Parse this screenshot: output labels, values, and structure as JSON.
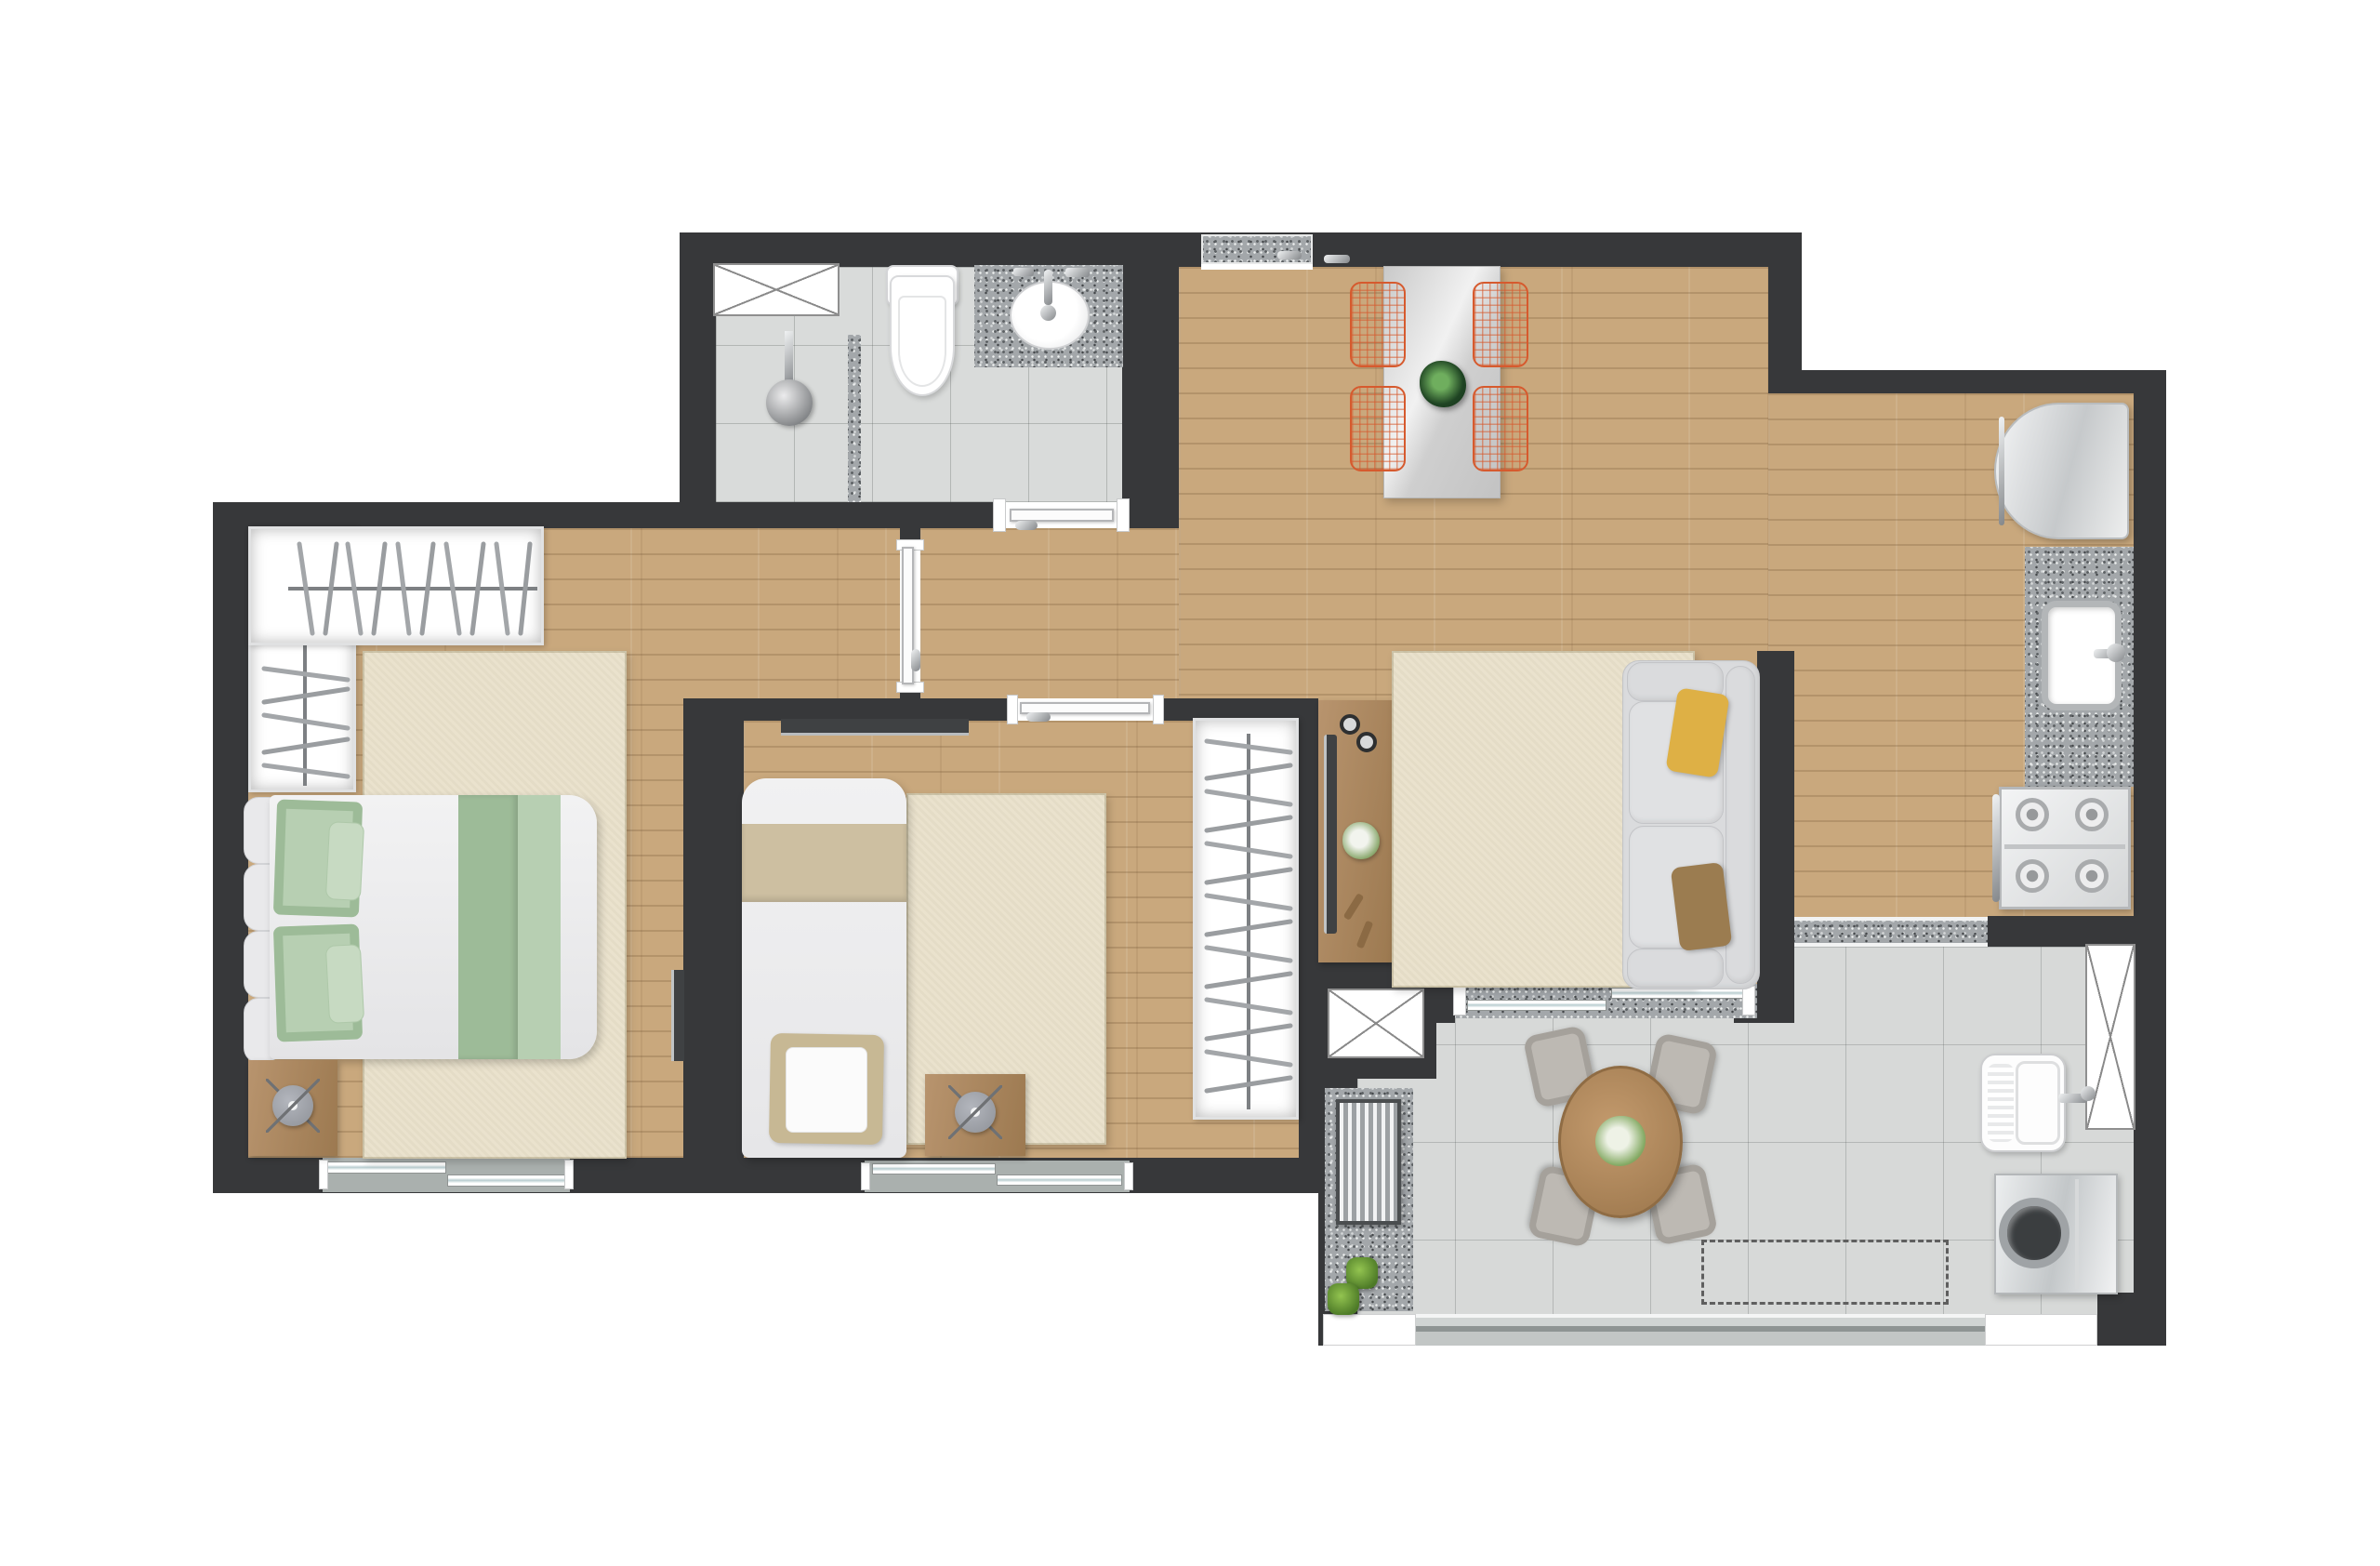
{
  "document": {
    "kind": "apartment-floor-plan",
    "text_labels": []
  },
  "colors": {
    "wall": "#37383a",
    "wood": "#c9a87d",
    "tile": "#d9dbda",
    "stile": "#d7d9d8",
    "granite": "#a3a7aa",
    "rug": "#eae2cd",
    "sill": "#aab0ae",
    "orange": "#d65a2e",
    "sofa": "#dadbdd",
    "gchair": "#bdb9b3",
    "green1": "#9dbb98",
    "green2": "#b7cfb2",
    "band": "#cdbfa1",
    "yellow": "#deb045",
    "brown": "#9b7c50",
    "woodfurn": "#ad875d",
    "tv": "#3f4143",
    "dash": "#5f5f5f"
  },
  "rooms": [
    {
      "name": "bathroom",
      "fixtures": [
        "window-x",
        "shower-head",
        "shower-divider",
        "toilet",
        "vanity-counter",
        "vanity-sink",
        "door"
      ]
    },
    {
      "name": "dining-area",
      "fixtures": [
        "window-sill-granite",
        "dining-table",
        "wire-chair x4",
        "table-plant"
      ]
    },
    {
      "name": "kitchen",
      "fixtures": [
        "fridge",
        "counter-granite",
        "kitchen-sink",
        "stove-4-burners",
        "threshold-granite"
      ]
    },
    {
      "name": "bedroom-1",
      "fixtures": [
        "open-wardrobe-L",
        "double-bed",
        "green-pillows",
        "nightstand",
        "stool",
        "tv",
        "rug",
        "sliding-window"
      ]
    },
    {
      "name": "bedroom-2",
      "fixtures": [
        "tv-panel",
        "single-bed",
        "rug",
        "desk",
        "stool",
        "open-wardrobe",
        "door",
        "sliding-window"
      ]
    },
    {
      "name": "living-room",
      "fixtures": [
        "tv-console",
        "tv",
        "speakers",
        "flowers",
        "remotes",
        "rug",
        "sofa",
        "yellow-pillow",
        "brown-pillow",
        "sliding-door"
      ]
    },
    {
      "name": "service-balcony",
      "fixtures": [
        "vent-shaft-x",
        "granite-ledge",
        "ac-unit",
        "plants x2",
        "round-table",
        "gray-chair x4",
        "flowers",
        "dashed-future-cabinet",
        "laundry-tank",
        "washing-machine",
        "window-x",
        "glazed-rail"
      ]
    }
  ]
}
